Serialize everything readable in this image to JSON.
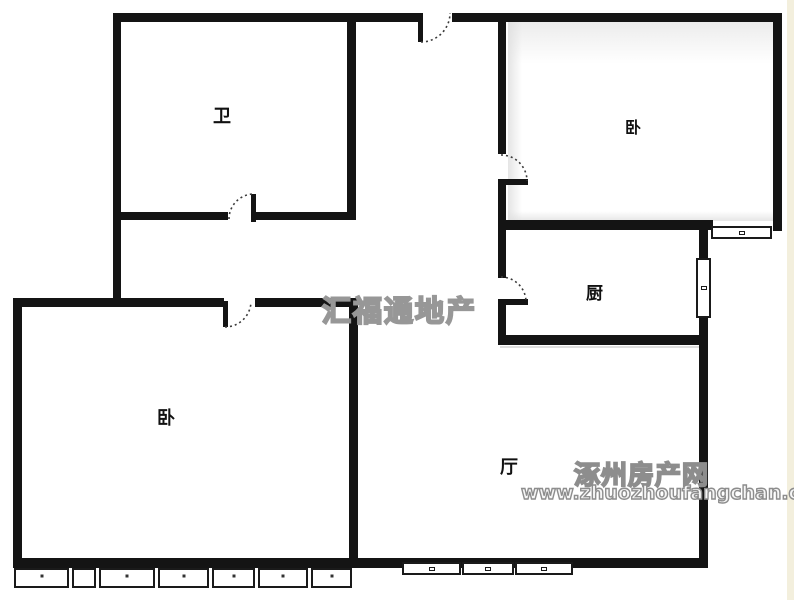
{
  "floorplan": {
    "rooms": [
      {
        "id": "bathroom",
        "label": "卫"
      },
      {
        "id": "bedroom-top",
        "label": "卧"
      },
      {
        "id": "kitchen",
        "label": "厨"
      },
      {
        "id": "bedroom-left",
        "label": "卧"
      },
      {
        "id": "living-room",
        "label": "厅"
      }
    ],
    "watermarks": {
      "center_agency": "汇福通地产",
      "site_name": "涿州房产网",
      "site_url": "www.zhuozhoufangchan.com"
    },
    "colors": {
      "wall": "#141414",
      "paper": "#ffffff",
      "watermark_gray": "#979797",
      "scan_strip": "#f3efdd"
    }
  }
}
